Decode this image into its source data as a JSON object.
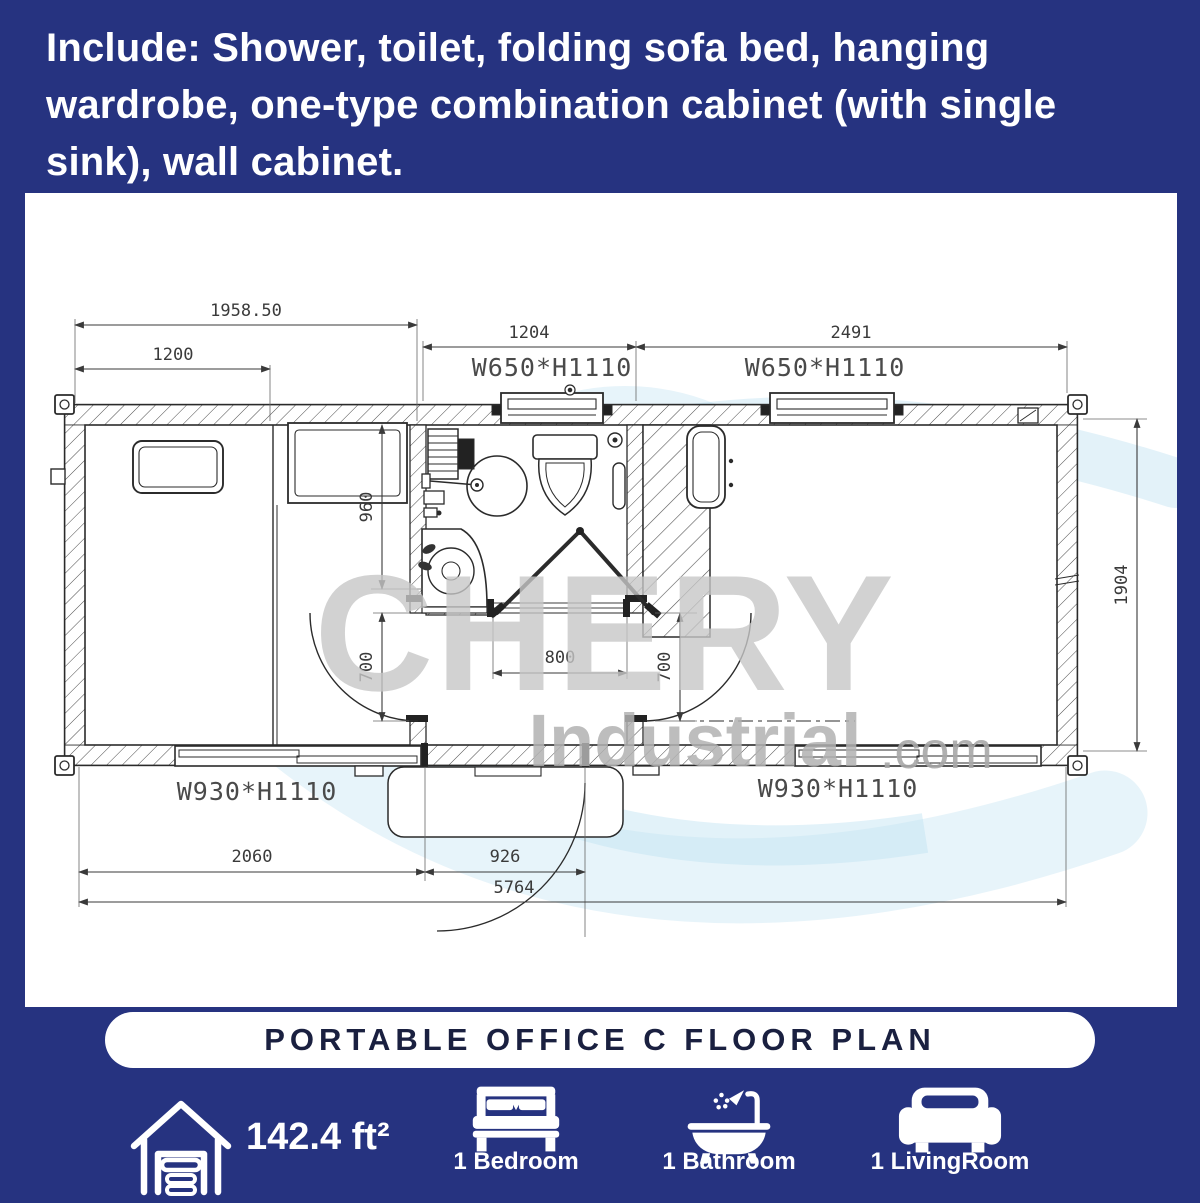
{
  "header": {
    "lines": [
      "Include: Shower, toilet, folding sofa bed, hanging",
      "wardrobe, one-type combination cabinet (with single",
      "sink), wall cabinet."
    ]
  },
  "plan": {
    "watermark": {
      "brand": "CHERY",
      "name": "Industrial",
      "tld": ".com"
    },
    "dims": {
      "top_total": "1958.50",
      "top_left": "1200",
      "bath_width": "1204",
      "right_room": "2491",
      "bath_depth": "960",
      "left_door": "700",
      "bath_door": "800",
      "right_door": "700",
      "height": "1904",
      "bottom_left": "2060",
      "entry_door": "926",
      "total_width": "5764"
    },
    "windows": {
      "top_bath": "W650*H1110",
      "top_right": "W650*H1110",
      "bottom_left": "W930*H1110",
      "bottom_right": "W930*H1110"
    }
  },
  "banner": {
    "title": "PORTABLE OFFICE C FLOOR PLAN"
  },
  "footer": {
    "area": {
      "value": "142.4 ft²"
    },
    "bedroom": {
      "label": "1 Bedroom"
    },
    "bathroom": {
      "label": "1 Bathroom"
    },
    "livingroom": {
      "label": "1 LivingRoom"
    }
  },
  "colors": {
    "background": "#263380",
    "card": "#ffffff",
    "line": "#2b2b2b",
    "dim_text": "#3a3a3a",
    "watermark_gray": "#c7c7c7",
    "watermark_blue": "#aed9ef",
    "banner_text": "#1a2040"
  }
}
